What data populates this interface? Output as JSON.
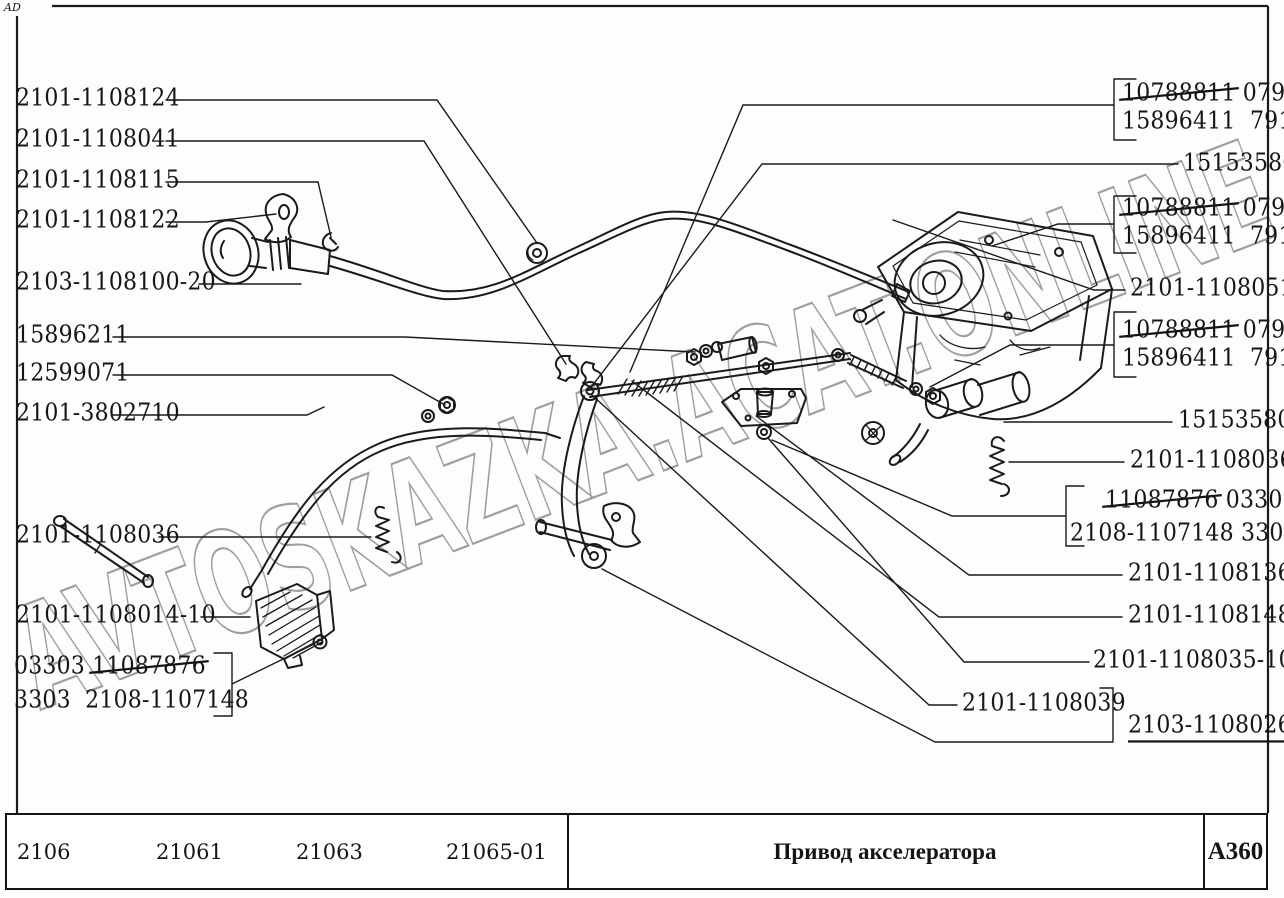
{
  "page": {
    "corner_mark": "AD"
  },
  "watermark": {
    "text": "AVTOSKAZKA.ACAT.ONLINE",
    "color": "#9e9e9e"
  },
  "diagram": {
    "ink": "#1a1a1a",
    "title_hint": "accelerator-drive-line-art"
  },
  "labels": {
    "left_labels": [
      "2101-1108124",
      "2101-1108041",
      "2101-1108115",
      "2101-1108122",
      "2103-1108100-20",
      "15896211",
      "12599071",
      "2101-3802710",
      "2101-1108036",
      "2101-1108014-10"
    ],
    "left_group": {
      "line1_prefix": "03303 ",
      "line1_strike": "11087876",
      "line2": "3303  2108-1107148"
    },
    "right_boxes": [
      {
        "line1_strike": "10788811",
        "line1_rest": " 0791",
        "line2": "15896411  791"
      },
      {
        "line1_strike": "10788811",
        "line1_rest": " 0791",
        "line2": "15896411  791"
      },
      {
        "line1_strike": "10788811",
        "line1_rest": " 0791",
        "line2": "15896411  791"
      }
    ],
    "right_labels": [
      "15153580",
      "2101-1108051",
      "15153580",
      "2101-1108036",
      "2101-1108136",
      "2101-1108148",
      "2101-1108035-10",
      "2101-1108039",
      "2103-1108026"
    ],
    "right_group": {
      "line1_strike": "11087876",
      "line1_rest": " 03303",
      "line2": "2108-1107148 3303"
    }
  },
  "footer": {
    "models": [
      "2106",
      "21061",
      "21063",
      "21065-01"
    ],
    "title": "Привод акселератора",
    "code": "A360"
  }
}
